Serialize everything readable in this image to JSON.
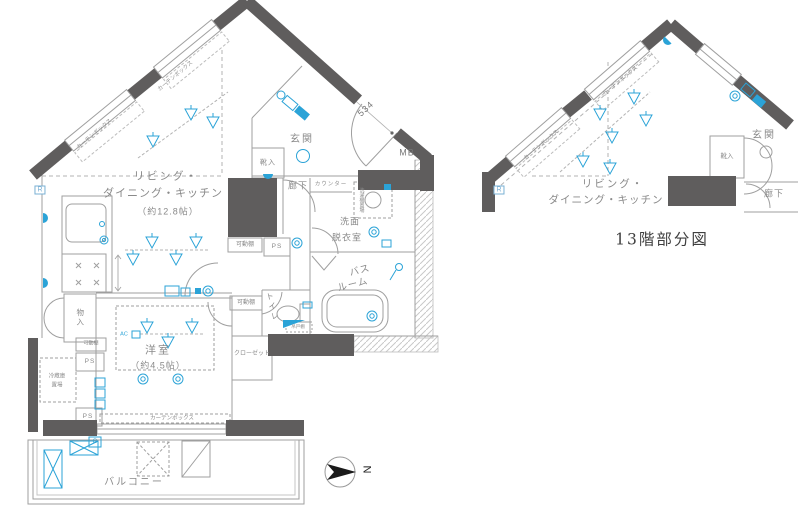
{
  "colors": {
    "wall": "#5f5d5d",
    "thin_line": "#9f9f9f",
    "accent_blue": "#2ba3d7",
    "label_text": "#8a8a8a",
    "caption_text": "#3f3f3f"
  },
  "main_plan": {
    "ldk_line1": "リビング・",
    "ldk_line2": "ダイニング・キッチン",
    "ldk_area": "（約12.8帖）",
    "genkan": "玄関",
    "kutsuire": "靴入",
    "mb": "MB",
    "rouka": "廊下",
    "counter": "カウンター",
    "senmen_line1": "洗面",
    "senmen_line2": "脱衣室",
    "sentakuki": "洗濯機置場",
    "bath_line1": "バス",
    "bath_line2": "ルーム",
    "toilet": "トイレ",
    "tsuridana": "吊戸棚",
    "kadodana": "可動棚",
    "ps": "PS",
    "closet": "クローゼット",
    "yoshitsu": "洋室",
    "yoshitsu_area": "（約4.5帖）",
    "monoire": "物入",
    "reizoko_line1": "冷蔵庫",
    "reizoko_line2": "置場",
    "curtain_box": "カーテンボックス",
    "balcony": "バルコニー",
    "dim_534": "534",
    "r_mark": "R",
    "g_mark": "G",
    "ac_mark": "AC"
  },
  "partial_plan": {
    "caption": "13階部分図",
    "ldk_line1": "リビング・",
    "ldk_line2": "ダイニング・キッチン",
    "genkan": "玄関",
    "kutsuire": "靴入",
    "rouka": "廊下",
    "curtain_box": "カーテンボックス",
    "r_mark": "R"
  },
  "compass": {
    "north_label": "N"
  }
}
